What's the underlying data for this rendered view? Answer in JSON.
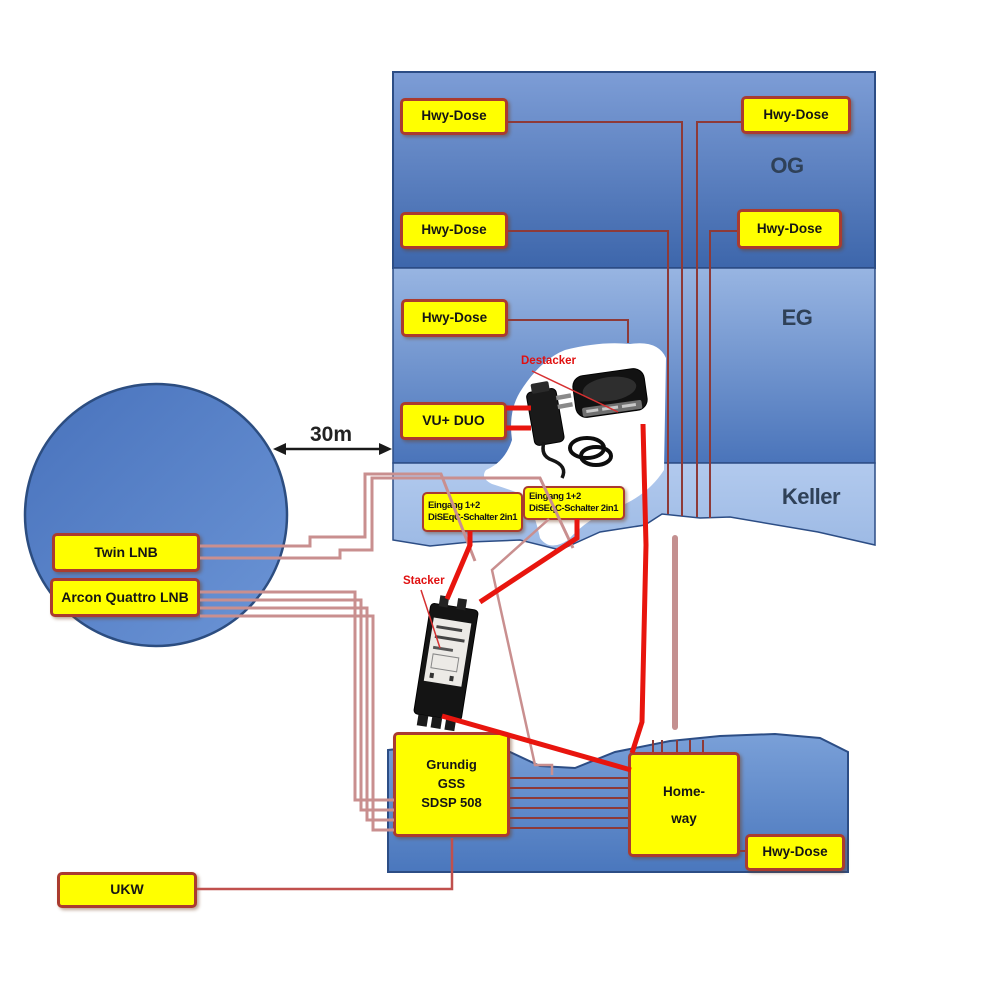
{
  "colors": {
    "yellow": "#ffff00",
    "box_border": "#aa3b2f",
    "wire_dark": "#8e3a38",
    "wire_pink": "#c98f8f",
    "wire_red": "#e8150e",
    "wire_ukw": "#c0504d",
    "label_navy": "#2f4158",
    "label_red": "#e01010",
    "arrow": "#1a1a1a",
    "building_og": "#3d66ab",
    "building_eg": "#4a74ba",
    "building_keller": "#a9c4ea",
    "building_bottom": "#4a77bd",
    "dish_circle": "#4d7cc6"
  },
  "floors": {
    "og": "OG",
    "eg": "EG",
    "keller": "Keller"
  },
  "boxes": {
    "hwy_dose": "Hwy-Dose",
    "vu_duo": "VU+ DUO",
    "diseqc": "Eingang 1+2\nDiSEqC-Schalter 2in1",
    "twin_lnb": "Twin LNB",
    "arcon_quattro_lnb": "Arcon Quattro LNB",
    "grundig": "Grundig\nGSS\nSDSP 508",
    "homeway": "Home-\nway",
    "ukw": "UKW"
  },
  "annotations": {
    "distance": "30m",
    "stacker": "Stacker",
    "destacker": "Destacker"
  }
}
